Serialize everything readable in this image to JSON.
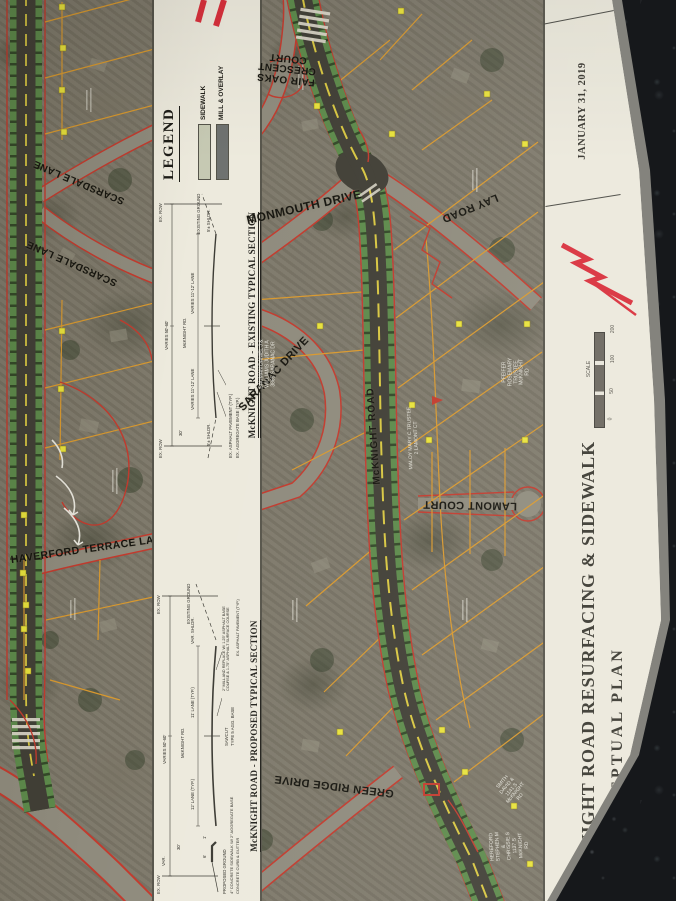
{
  "title_block": {
    "project_title": "McKNIGHT ROAD RESURFACING & SIDEWALK",
    "subtitle": "CONCEPTUAL PLAN",
    "date": "JANUARY 31, 2019",
    "scale_label": "SCALE",
    "scale_ticks": [
      "0",
      "50",
      "100",
      "200"
    ]
  },
  "legend": {
    "title": "LEGEND",
    "items": [
      {
        "label": "SIDEWALK",
        "color": "#c6c9b3"
      },
      {
        "label": "MILL & OVERLAY",
        "color": "#6f7270"
      }
    ]
  },
  "sections": {
    "existing": {
      "title": "McKNIGHT ROAD - EXISTING TYPICAL SECTION",
      "labels": {
        "row_left": "EX. ROW",
        "row_right": "EX. ROW",
        "overall": "VARIES 50'-60'",
        "centerline": "McKNIGHT RD.",
        "lane_left": "VARIES 11'-12' LANE",
        "lane_right": "VARIES 11'-12' LANE",
        "shoulder_left": "5'± SHLDR.",
        "shoulder_right": "5'± SHLDR.",
        "offset": "30'",
        "pavement": "EX. ASPHALT PAVEMENT (TYP.)",
        "base": "EX. AGGREGATE BASE (TYP.)",
        "ground": "EXISTING GROUND"
      }
    },
    "proposed": {
      "title": "McKNIGHT ROAD - PROPOSED TYPICAL SECTION",
      "labels": {
        "row_left": "EX. ROW",
        "row_right": "EX. ROW",
        "var_left": "VAR.",
        "overall": "VARIES 50'-60'",
        "centerline": "McKNIGHT RD.",
        "lane_left": "12' LANE (TYP.)",
        "lane_right": "11' LANE (TYP.)",
        "shoulder": "VAR. SHLDR.",
        "offset": "30'",
        "sidewalk_width": "6'",
        "buffer": "1'",
        "proposed_ground": "PROPOSED GROUND",
        "sidewalk": "4\" CONCRETE SIDEWALK W/ 2\" AGGREGATE BASE",
        "curb": "CONCRETE CURB & GUTTER",
        "sawcut": "SAWCUT",
        "agg_base": "TYPE 5 AGG. BASE",
        "mill": "2\" MILL AND REPLACE W/ 1.25\" ASPHALT BASE COURSE & 1.75\" ASPHALT SURFACE COURSE",
        "pavement": "EX. ASPHALT PAVEMENT (TYP.)",
        "base": "EX. AGGREGATE BASE (TYP.)",
        "ground": "EXISTING GROUND"
      }
    }
  },
  "map": {
    "streets": [
      {
        "name": "FAIR OAKS CRESCENT COURT"
      },
      {
        "name": "MONMOUTH DRIVE"
      },
      {
        "name": "LAY ROAD"
      },
      {
        "name": "SARANAC DRIVE"
      },
      {
        "name": "McKNIGHT ROAD"
      },
      {
        "name": "LAMONT COURT"
      },
      {
        "name": "GREEN RIDGE DRIVE"
      },
      {
        "name": "SCARSDALE LANE"
      },
      {
        "name": "SCARSDALE LANE"
      },
      {
        "name": "HAVERFORD TERRACE LANE"
      }
    ],
    "parcels": [
      {
        "text": "BAUMAN DANIEL J &\nWILLIAMS JUDITH A\n3865 SARANAC DR"
      },
      {
        "text": "MALOY MARY C TRUSTEE\n2 LAMONT CT"
      },
      {
        "text": "PFEIFER ROSEMARY TRUSTEE\nMcKNIGHT RD"
      },
      {
        "text": "HEREFORD STEPHEN M &\nCHRISSIE S\n1137 S McKNIGHT RD"
      },
      {
        "text": "SMITH DAVID &\n1141 S McKNIGHT RD"
      }
    ]
  },
  "colors": {
    "sidewalk_green": "#5d8a4b",
    "asphalt": "#413f36",
    "parcel_line_orange": "#d9992e",
    "row_red": "#c23b2e",
    "dot_yellow": "#e8e23c",
    "logo_red": "#d9303c"
  }
}
